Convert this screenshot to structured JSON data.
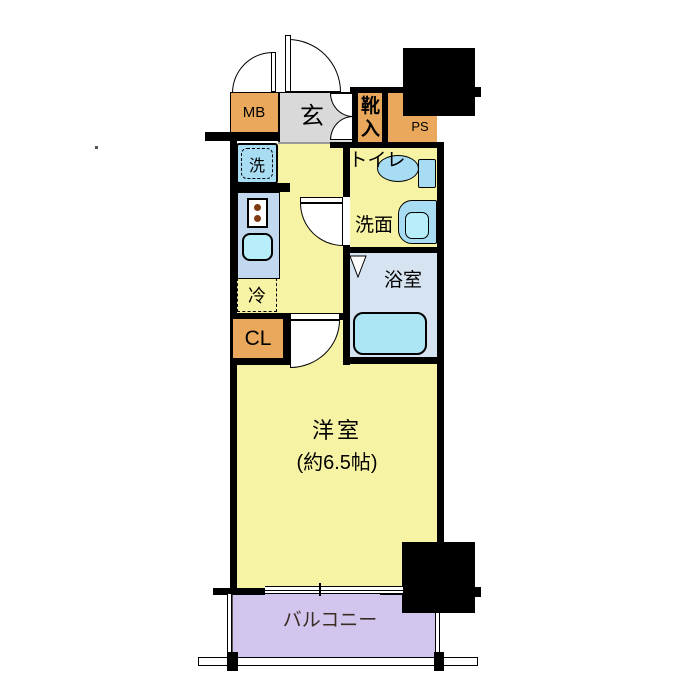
{
  "title": "apartment-floor-plan",
  "labels": {
    "mb": "MB",
    "genkan": "玄",
    "shoe_storage": "靴入",
    "ps": "PS",
    "toilet": "トイレ",
    "washroom": "洗面",
    "bathroom": "浴室",
    "washer": "洗",
    "fridge": "冷",
    "closet": "CL",
    "main_room": "洋室",
    "main_room_size": "(約6.5帖)",
    "balcony": "バルコニー"
  },
  "colors": {
    "wall": "#000000",
    "orange": "#E9A85C",
    "yellow": "#F7F3A4",
    "gray": "#D9D9D9",
    "balcony": "#D2C6EE",
    "bath_floor": "#D6E4F2",
    "fixture": "#A8DCF2",
    "tub": "#ACE6F4",
    "counter": "#C2D8EE",
    "sink": "#B8EEFA",
    "stove_dot": "#7E3B12",
    "text": "#000000"
  }
}
